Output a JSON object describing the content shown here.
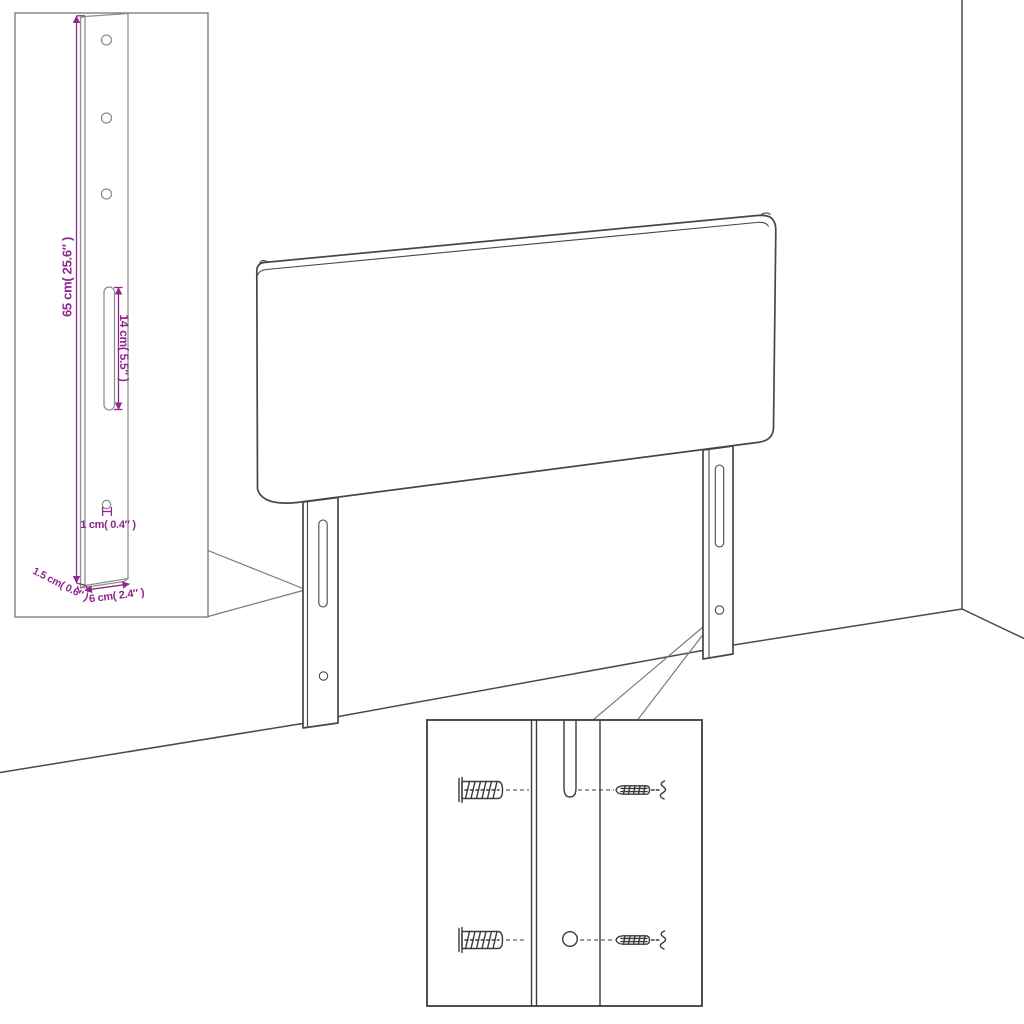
{
  "colors": {
    "background": "#ffffff",
    "line_art": "#474747",
    "inset_line_art": "#8f8f8f",
    "dimension_accent": "#90278e"
  },
  "callout_leg": {
    "height": "65 cm( 25.6″ )",
    "slot_length": "14 cm( 5.5″ )",
    "hole_diameter": "1 cm( 0.4″ )",
    "thickness": "1.5 cm( 0.6″ )",
    "width": "6 cm( 2.4″ )"
  }
}
